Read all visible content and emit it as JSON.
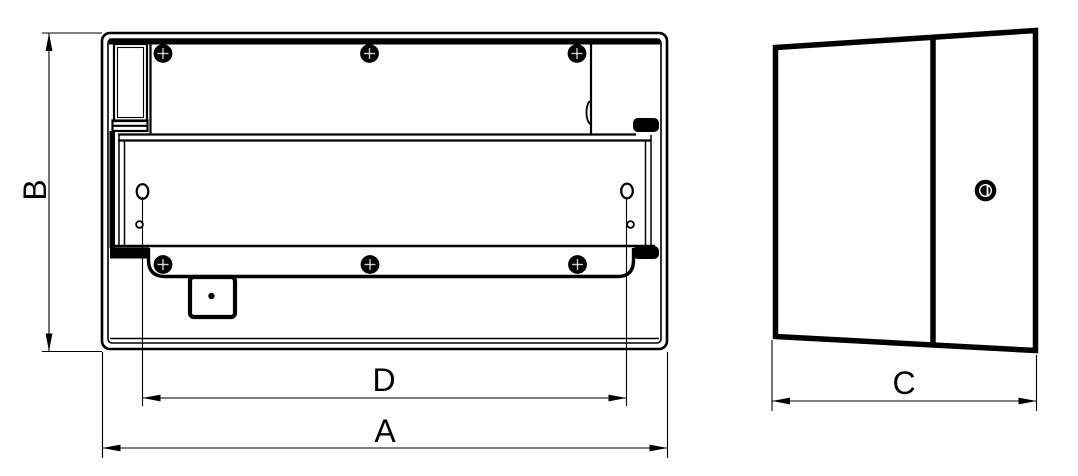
{
  "drawing": {
    "colors": {
      "ink": "#000000",
      "paper": "#ffffff"
    },
    "dimensions": {
      "a": {
        "label": "A"
      },
      "b": {
        "label": "B"
      },
      "c": {
        "label": "C"
      },
      "d": {
        "label": "D"
      }
    }
  }
}
